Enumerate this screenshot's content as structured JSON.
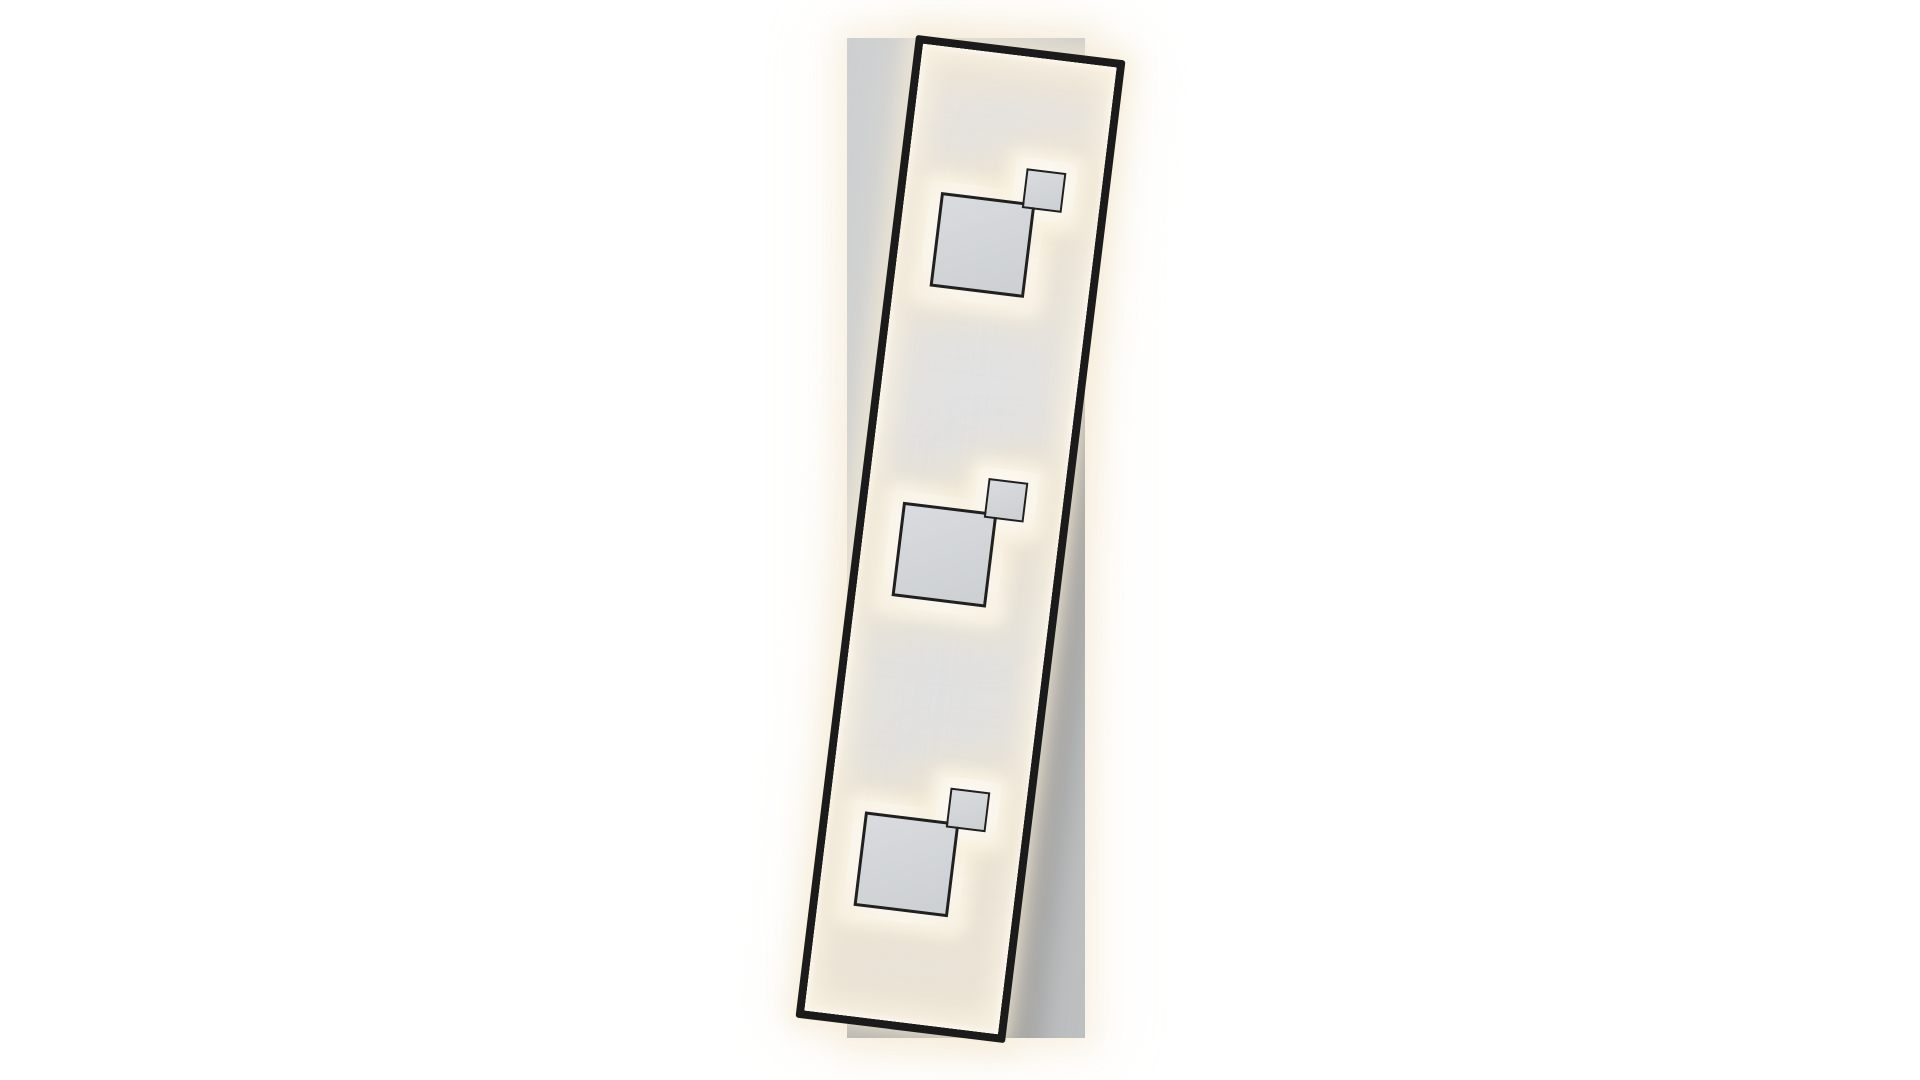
{
  "scene": {
    "description": "Product photograph of a rectangular LED ceiling light on a white background: a light-gray vertical backdrop plate behind a slightly tilted elongated black metal frame whose inner panel is edge-lit with warm white LED light and carries three identical groups of two overlapping outlined squares, each group backed by a glowing warm-white plate",
    "image_type": "product-photo",
    "text_content": "none",
    "fixture": {
      "backdrop_panel": {
        "shape": "upright rectangle, axis-aligned",
        "color": "#c6c8ca",
        "halo_color": "#f7eede"
      },
      "frame": {
        "shape": "elongated rectangle",
        "rotation_deg": 7,
        "rotation_direction": "clockwise",
        "border_color": "#1b1b1b",
        "border_thickness_px": 8,
        "outer_glow_color": "#f6ecd8"
      },
      "inner_panel": {
        "base_color": "#e0e1e2",
        "edge_glow_color": "#fdf9f0",
        "glow_tint": "warm white"
      },
      "light_group_count": 3,
      "light_groups": [
        {
          "id": 1,
          "position": "top",
          "large_square": {
            "size_px": 95,
            "outline_color": "#202020",
            "fill_color": "#d3d6d9"
          },
          "small_square": {
            "size_px": 40,
            "outline_color": "#202020",
            "fill_color": "#d3d6d9"
          },
          "arrangement": "small square overlaps large square's top-right corner",
          "glow_plate_color": "#faf5ea"
        },
        {
          "id": 2,
          "position": "middle",
          "large_square": {
            "size_px": 95,
            "outline_color": "#202020",
            "fill_color": "#d3d6d9"
          },
          "small_square": {
            "size_px": 40,
            "outline_color": "#202020",
            "fill_color": "#d3d6d9"
          },
          "arrangement": "small square overlaps large square's top-right corner",
          "glow_plate_color": "#faf5ea"
        },
        {
          "id": 3,
          "position": "bottom",
          "large_square": {
            "size_px": 95,
            "outline_color": "#202020",
            "fill_color": "#d3d6d9"
          },
          "small_square": {
            "size_px": 40,
            "outline_color": "#202020",
            "fill_color": "#d3d6d9"
          },
          "arrangement": "small square overlaps large square's top-right corner",
          "glow_plate_color": "#faf5ea"
        }
      ],
      "cast_shadow_color": "#484b50"
    },
    "colors": {
      "page_bg": "#ffffff",
      "backdrop_light": "#cdcfd1",
      "backdrop_mid": "#c6c8ca",
      "backdrop_dark": "#bdbfc1",
      "frame_black": "#1b1b1b",
      "outline_black": "#202020",
      "square_fill_light": "#d9dbde",
      "square_fill_dark": "#cdd0d3",
      "panel_gray": "#e0e1e2",
      "panel_warm": "#ece5d6",
      "glow_bright": "#fdf9f0",
      "glow_warm": "#f6eedd",
      "glow_amber": "#f0dfc2"
    }
  }
}
